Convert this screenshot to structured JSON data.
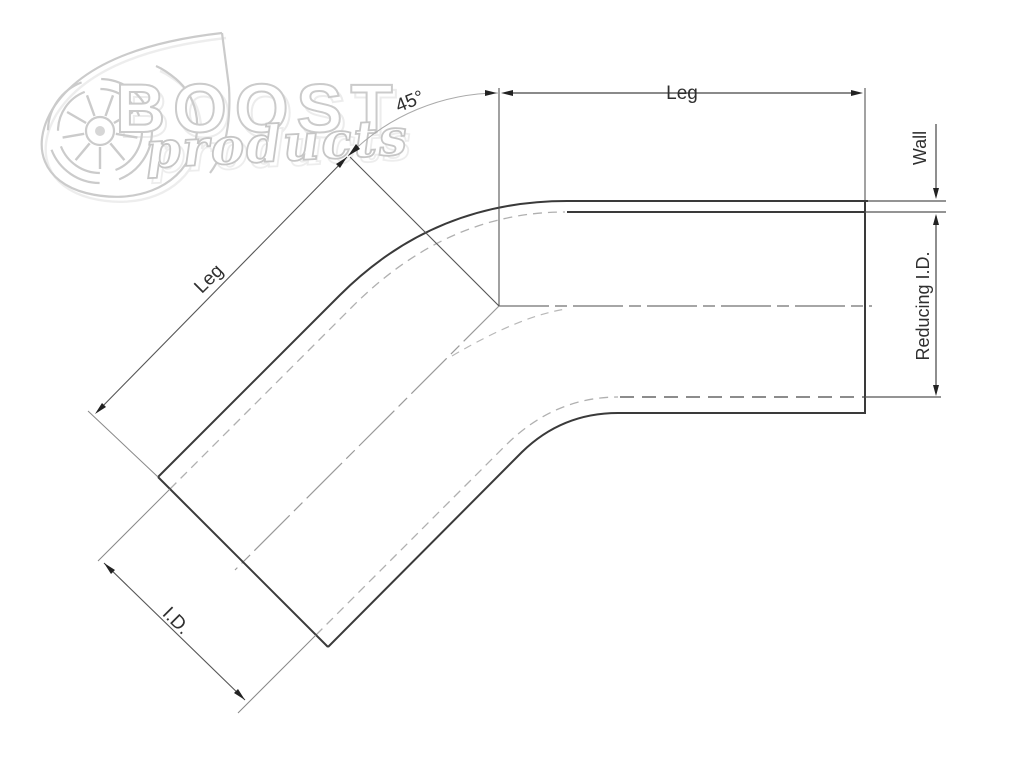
{
  "page": {
    "background": "#ffffff",
    "kind": "technical-dimension-drawing"
  },
  "colors": {
    "outline": "#3a3a3a",
    "dimension_line": "#555555",
    "extension_line": "#888888",
    "hidden_line": "#b0b0b0",
    "hidden_line_dark": "#666666",
    "centerline": "#8f8f8f",
    "angle_arc": "#aaaaaa",
    "arrow_fill": "#222222",
    "label_text": "#2f2f2f",
    "logo_stroke": "#cbcbcb",
    "logo_shadow": "#eaeaea"
  },
  "logo": {
    "brand": "BOOST",
    "subtitle": "products",
    "icon": "turbocharger-icon"
  },
  "labels": {
    "angle": "45°",
    "leg_top": "Leg",
    "leg_diagonal": "Leg",
    "wall": "Wall",
    "reducing_id": "Reducing I.D.",
    "inner_diameter": "I.D."
  }
}
